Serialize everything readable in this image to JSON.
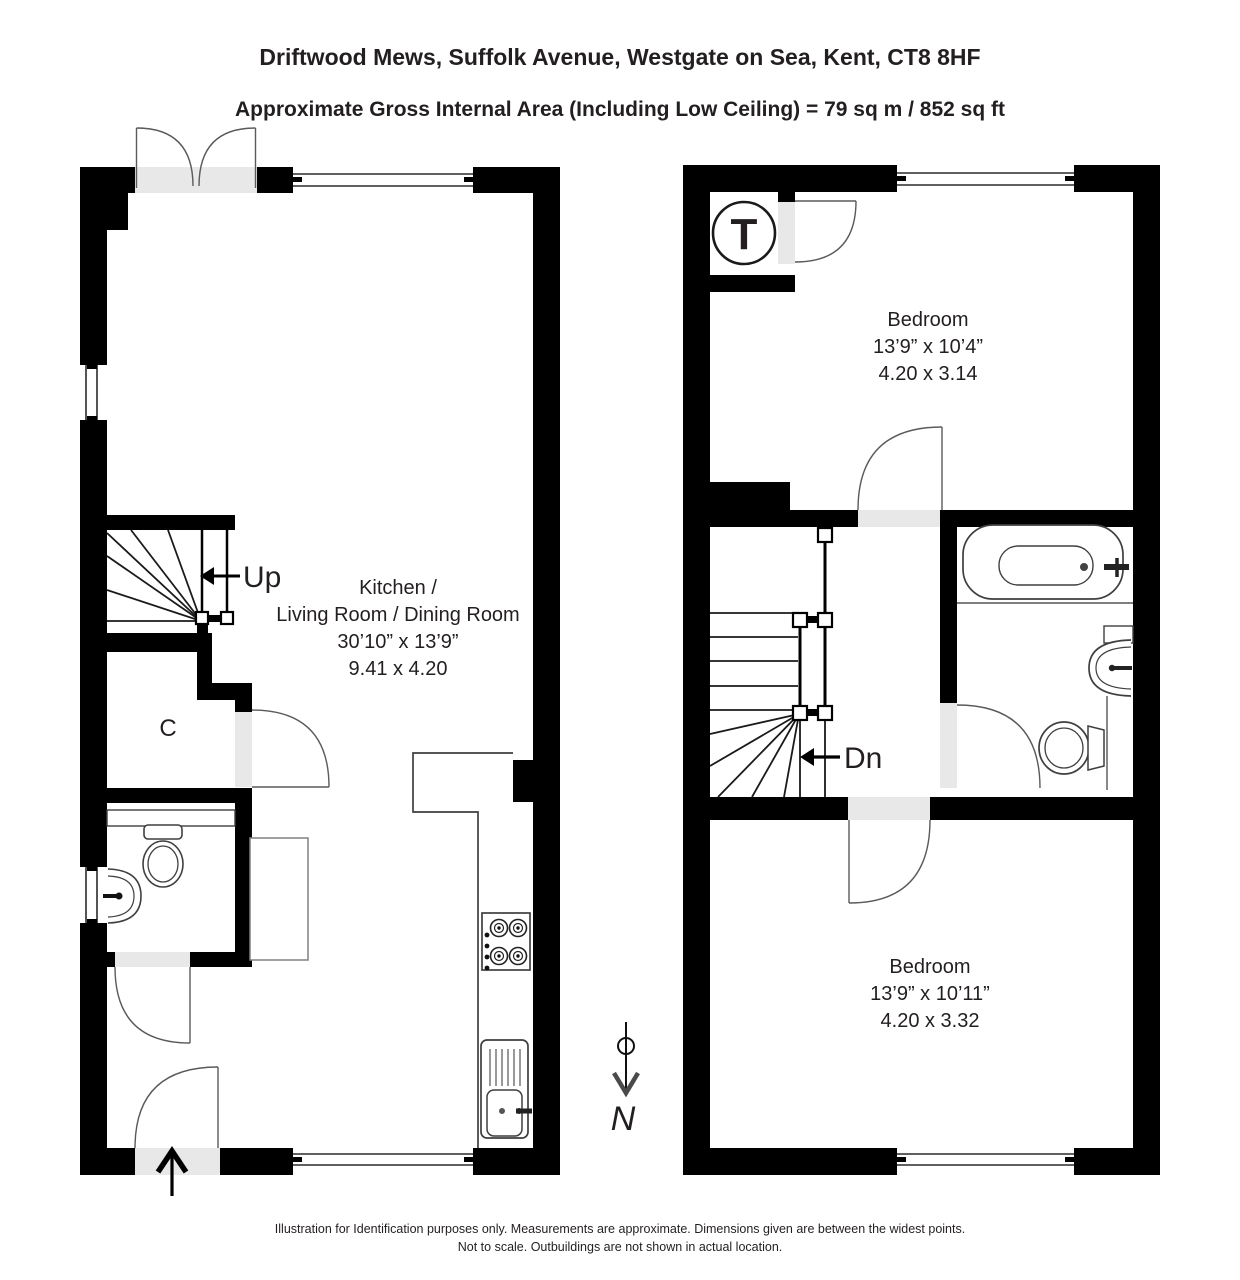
{
  "header": {
    "address": "Driftwood Mews, Suffolk Avenue, Westgate on Sea, Kent, CT8 8HF",
    "area": "Approximate Gross Internal Area (Including Low Ceiling) =  79 sq m / 852 sq ft"
  },
  "ground_floor": {
    "up_label": "Up",
    "closet_label": "C",
    "room_name_line1": "Kitchen /",
    "room_name_line2": "Living Room / Dining Room",
    "room_size_imperial": "30’10” x 13’9”",
    "room_size_metric": "9.41 x 4.20"
  },
  "first_floor": {
    "tank_label": "T",
    "down_label": "Dn",
    "bedroom_front_name": "Bedroom",
    "bedroom_front_imperial": "13’9” x 10’4”",
    "bedroom_front_metric": "4.20 x 3.14",
    "bedroom_back_name": "Bedroom",
    "bedroom_back_imperial": "13’9” x 10’11”",
    "bedroom_back_metric": "4.20 x 3.32"
  },
  "compass": {
    "north_label": "N"
  },
  "footer": {
    "line1": "Illustration for Identification purposes only.  Measurements are approximate. Dimensions given are between the widest points.",
    "line2": "Not to scale.  Outbuildings are not shown in actual location."
  },
  "colors": {
    "wall": "#000000",
    "door_fill": "#e8e8e8",
    "fixture_line": "#3f3f3f",
    "text": "#231f20"
  }
}
